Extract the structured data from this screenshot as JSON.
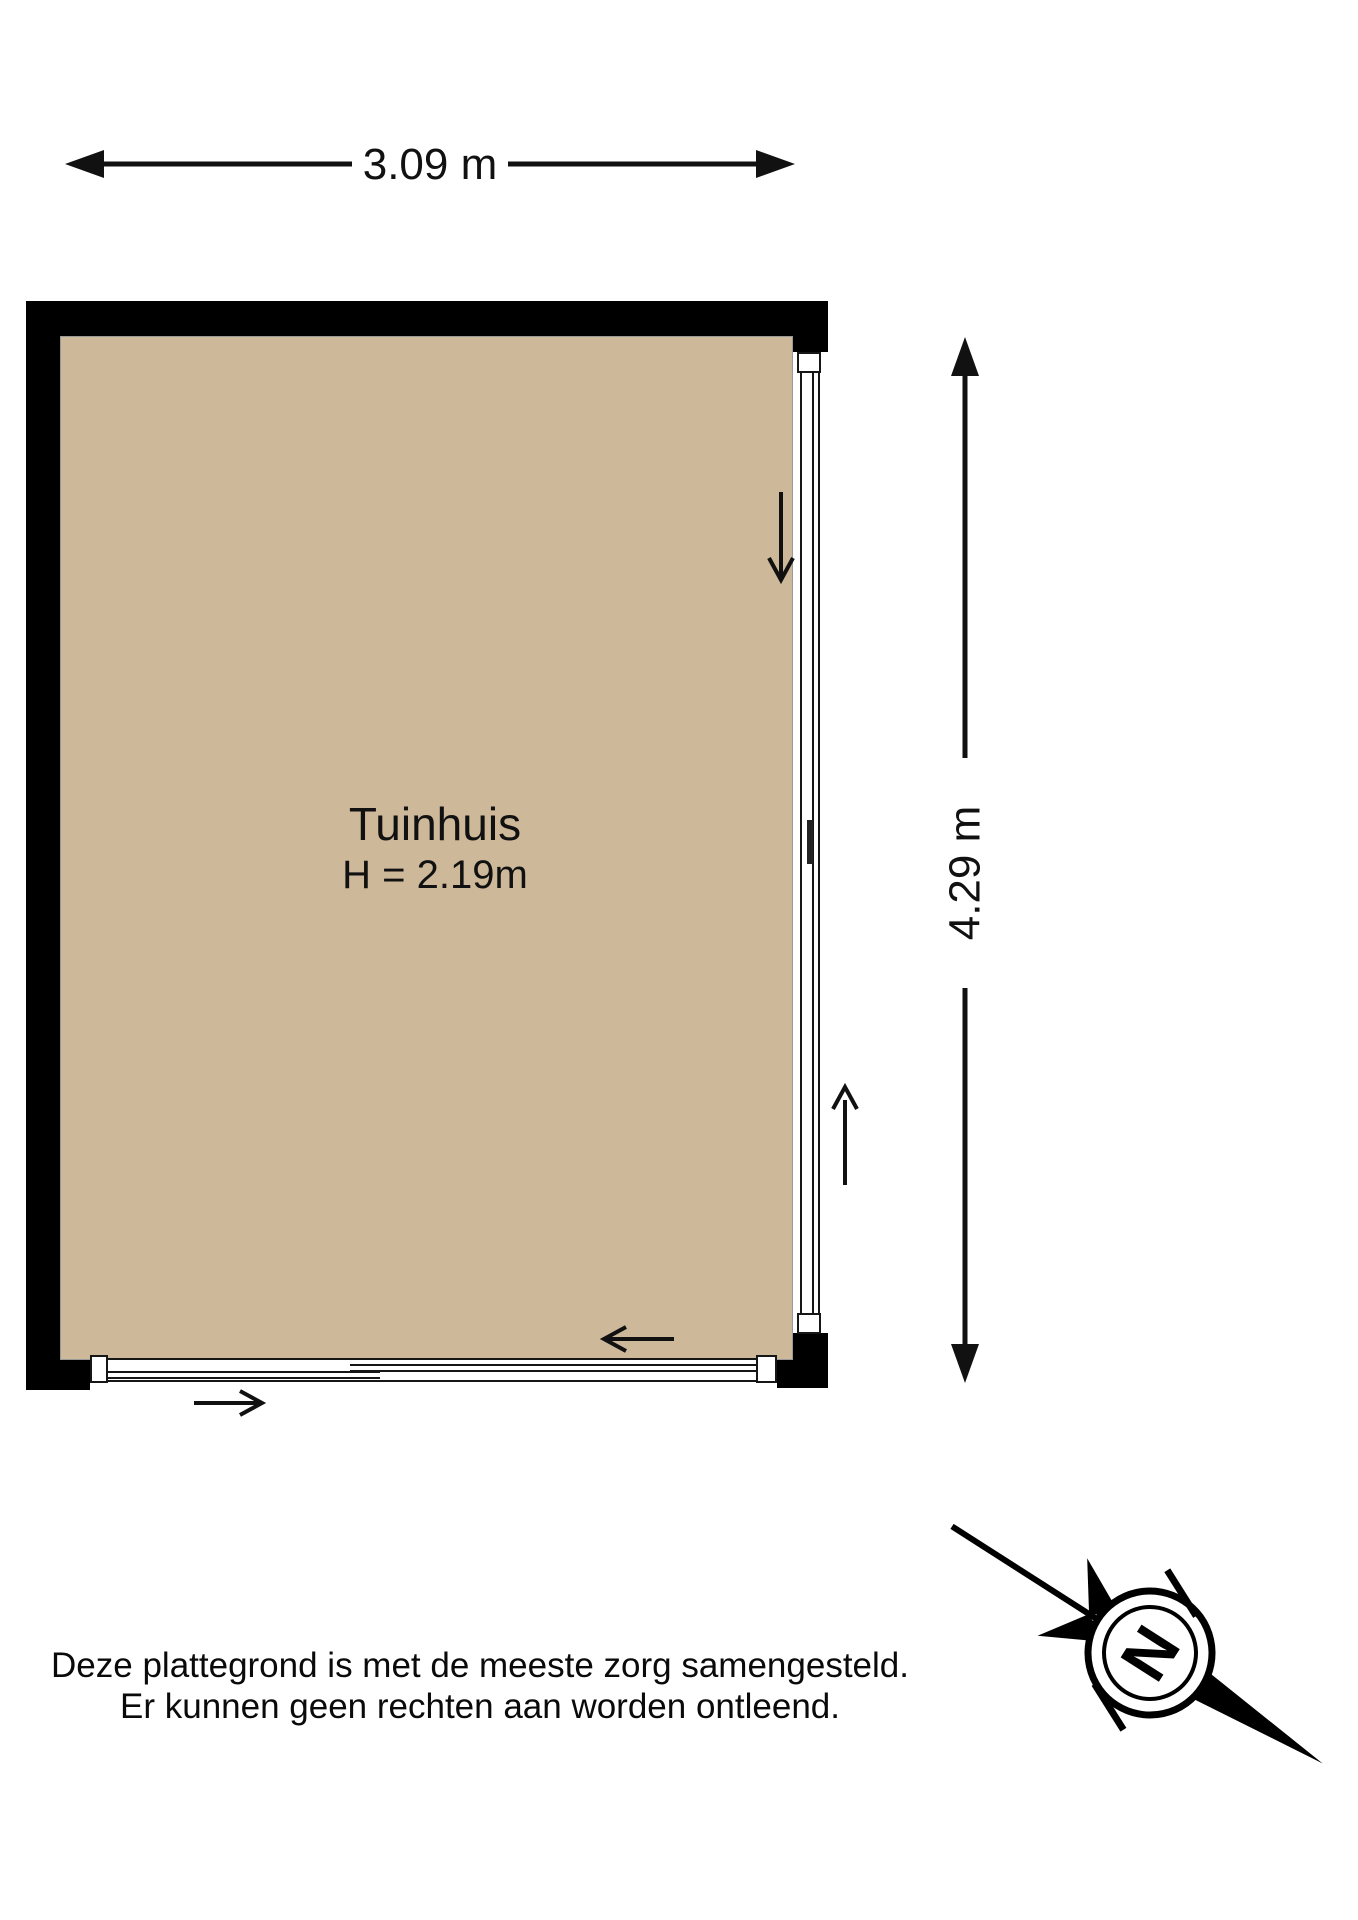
{
  "dimensions": {
    "width_label": "3.09 m",
    "height_label": "4.29 m"
  },
  "room": {
    "name": "Tuinhuis",
    "ceiling_height": "H = 2.19m"
  },
  "disclaimer": {
    "line1": "Deze plattegrond is met de meeste zorg samengesteld.",
    "line2": "Er kunnen geen rechten aan worden ontleend."
  },
  "compass": {
    "north_label": "N"
  },
  "colors": {
    "floor": "#CDB899",
    "wall": "#000000",
    "line": "#161616"
  }
}
